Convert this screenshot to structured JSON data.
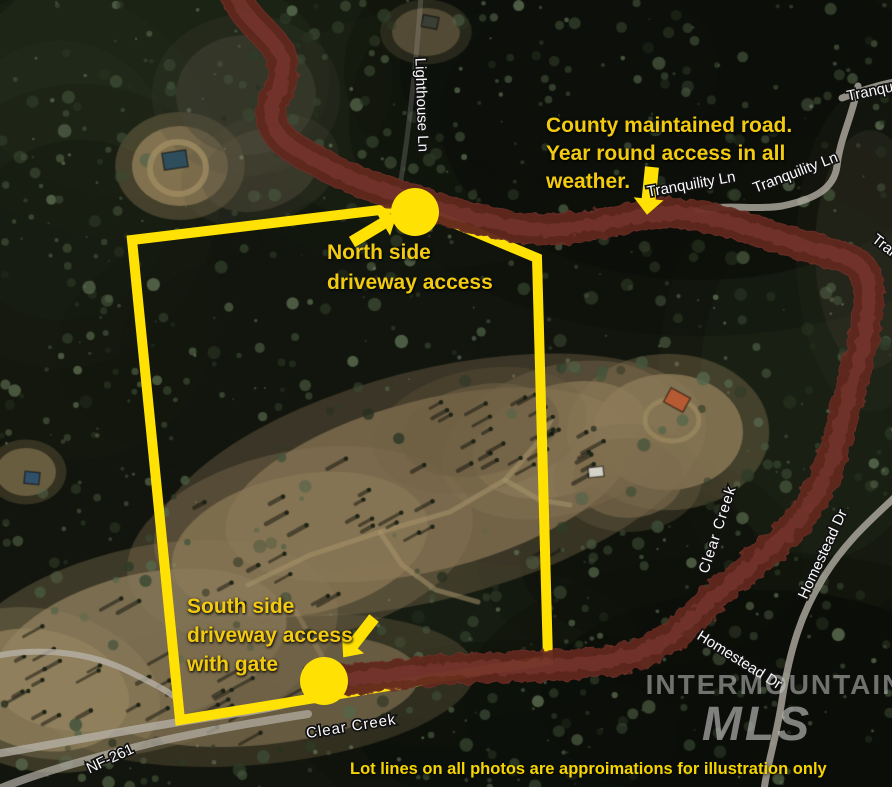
{
  "annotations": {
    "county_road": {
      "lines": [
        "County maintained road.",
        "Year round access in all",
        "weather."
      ]
    },
    "north_access": {
      "lines": [
        "North side",
        "driveway access"
      ]
    },
    "south_access": {
      "lines": [
        "South side",
        "driveway access",
        "with gate"
      ]
    },
    "disclaimer": "Lot lines on all photos are approimations for illustration only"
  },
  "road_labels": [
    {
      "text": "Lighthouse Ln"
    },
    {
      "text": "Tranquility Ln"
    },
    {
      "text": "Tranquility Ln"
    },
    {
      "text": "Tranqu"
    },
    {
      "text": "Tran"
    },
    {
      "text": "Clear Creek"
    },
    {
      "text": "Clear Creek"
    },
    {
      "text": "Homestead Dr"
    },
    {
      "text": "Homestead Dr"
    },
    {
      "text": "NF-261"
    }
  ],
  "watermark": {
    "primary": "INTERMOUNTAIN",
    "secondary": "MLS"
  },
  "colors": {
    "annotation_yellow": "#f2ca10",
    "boundary_yellow": "#ffe103",
    "road_highlight_red": "#6e2e26",
    "road_label_white": "#fafafa",
    "watermark_gray": "#d0d0d0"
  }
}
